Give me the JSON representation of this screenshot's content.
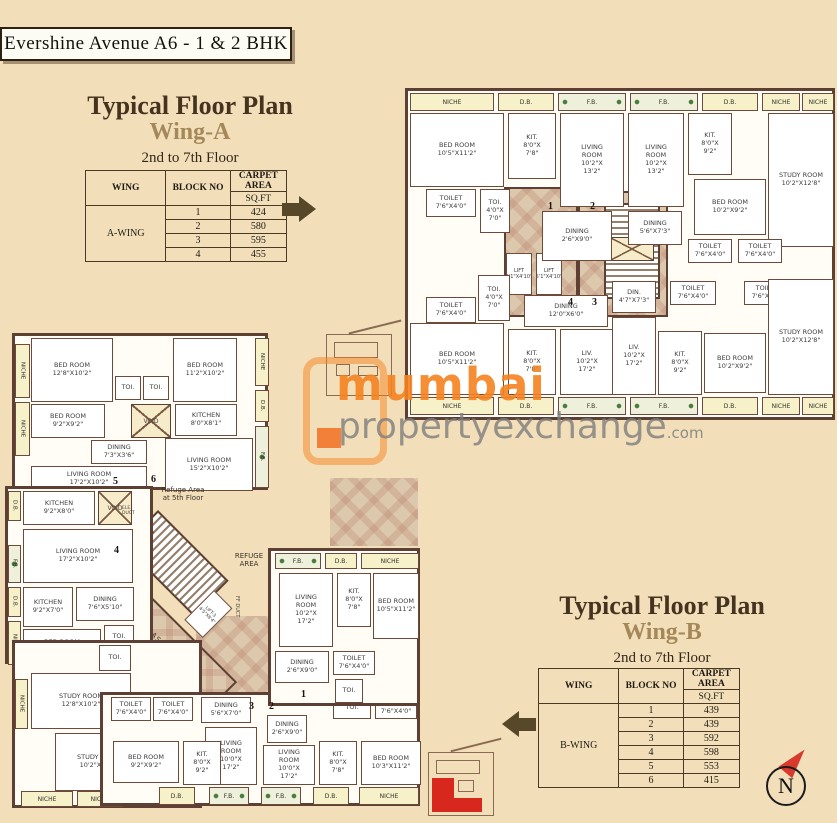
{
  "banner": {
    "title": "Evershine Avenue  A6 - 1 & 2 BHK"
  },
  "wing_a": {
    "heading": "Typical Floor Plan",
    "subheading": "Wing-A",
    "floors": "2nd to 7th Floor",
    "table": {
      "col_wing": "WING",
      "col_block": "BLOCK NO",
      "col_area": "CARPET AREA",
      "col_unit": "SQ.FT",
      "wing_name": "A-WING",
      "rows": [
        {
          "block": "1",
          "area": "424"
        },
        {
          "block": "2",
          "area": "580"
        },
        {
          "block": "3",
          "area": "595"
        },
        {
          "block": "4",
          "area": "455"
        }
      ]
    }
  },
  "wing_b": {
    "heading": "Typical Floor Plan",
    "subheading": "Wing-B",
    "floors": "2nd to 7th Floor",
    "table": {
      "col_wing": "WING",
      "col_block": "BLOCK NO",
      "col_area": "CARPET AREA",
      "col_unit": "SQ.FT",
      "wing_name": "B-WING",
      "rows": [
        {
          "block": "1",
          "area": "439"
        },
        {
          "block": "2",
          "area": "439"
        },
        {
          "block": "3",
          "area": "592"
        },
        {
          "block": "4",
          "area": "598"
        },
        {
          "block": "5",
          "area": "553"
        },
        {
          "block": "6",
          "area": "415"
        }
      ]
    }
  },
  "watermark": {
    "brand": "mumbai",
    "brand2": "propertyexchange",
    "tld": ".com"
  },
  "compass": {
    "label": "N"
  },
  "shared": {
    "niche": "NICHE",
    "db": "D.B.",
    "fb": "F.B.",
    "toi": "TOI.",
    "toi_dim": "TOI.\n4'0\"X\n7'0\"",
    "toilet": "TOILET\n7'6\"X4'0\"",
    "void": "VOID",
    "lift": "LIFT\n5'1\"X4'10\""
  },
  "plan_a": {
    "bed1": "BED ROOM\n10'5\"X11'2\"",
    "kit1": "KIT.\n8'0\"X\n7'8\"",
    "liv1": "LIVING\nROOM\n10'2\"X\n13'2\"",
    "din1": "DINING\n2'6\"X9'0\"",
    "din2": "DINING\n5'6\"X7'3\"",
    "kit2": "KIT.\n8'0\"X\n9'2\"",
    "bed2": "BED ROOM\n10'2\"X9'2\"",
    "study": "STUDY ROOM\n10'2\"X12'8\"",
    "din3": "DINING\n12'0\"X6'0\"",
    "din4": "DIN.\n4'7\"X7'3\"",
    "liv2": "LIV.\n10'2\"X\n17'2\"",
    "u1": "1",
    "u2": "2",
    "u3": "3",
    "u4": "4"
  },
  "plan_b": {
    "bed_a": "BED ROOM\n12'8\"X10'2\"",
    "bed_b": "BED ROOM\n9'2\"X9'2\"",
    "liv_a": "LIVING ROOM\n17'2\"X10'2\"",
    "din_a": "DINING\n7'3\"X3'6\"",
    "bed_c": "BED ROOM\n11'2\"X10'2\"",
    "kitchen_a": "KITCHEN\n8'0\"X8'1\"",
    "liv_b": "LIVING ROOM\n15'2\"X10'2\"",
    "kitchen_b": "KITCHEN\n9'2\"X8'0\"",
    "din_b": "DINING\n7'6\"X5'10\"",
    "kitchen_c": "KITCHEN\n9'2\"X7'0\"",
    "bed_d": "BED ROOM\n9'2\"X10'8\"",
    "study_a": "STUDY ROOM\n12'8\"X10'2\"",
    "study_b": "STUDY ROOM\n10'2\"X12'8\"",
    "din_c": "DINING\n5'6\"X7'0\"",
    "liv_c": "LIVING\nROOM\n10'0\"X\n17'2\"",
    "kit_a": "KIT.\n8'0\"X\n9'2\"",
    "kit_b": "KIT.\n8'0\"X\n7'8\"",
    "bed_e": "BED ROOM\n10'3\"X11'2\"",
    "liv_d": "LIVING\nROOM\n10'2\"X\n17'2\"",
    "bed_f": "BED ROOM\n10'5\"X11'2\"",
    "din_d": "DINING\n2'6\"X9'0\"",
    "refuge": "REFUGE\nAREA",
    "refuge5": "Refuge Area\nat 5th Floor",
    "passage": "5'0\" W. PASSAGE",
    "lift3": "LIFT-3\n4'5\"X8'4\"",
    "lift4": "LIFT-4\n4'5\"X8'4\"",
    "ffduct": "FF DUCT",
    "eleduct": "ELE.\nDUCT",
    "u1": "1",
    "u2": "2",
    "u3": "3",
    "u4": "4",
    "u5": "5",
    "u6": "6"
  }
}
